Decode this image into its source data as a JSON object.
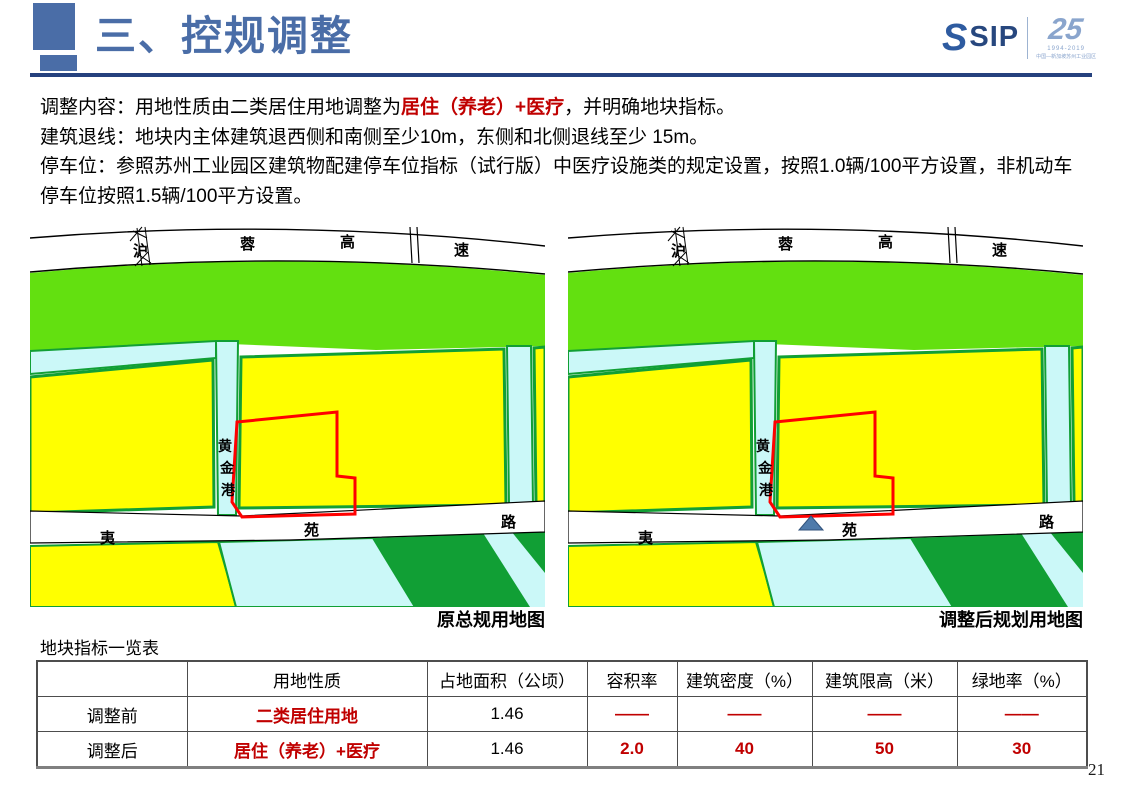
{
  "header": {
    "title": "三、控规调整",
    "logo": {
      "icon": "s-swoosh-icon",
      "sip": "SIP",
      "anniversary": "25",
      "years": "1994-2019",
      "org": "中国—新加坡苏州工业园区"
    }
  },
  "body": {
    "line1_prefix": "调整内容：用地性质由二类居住用地调整为",
    "line1_highlight": "居住（养老）+医疗",
    "line1_suffix": "，并明确地块指标。",
    "line2": "建筑退线：地块内主体建筑退西侧和南侧至少10m，东侧和北侧退线至少 15m。",
    "line3": "停车位：参照苏州工业园区建筑物配建停车位指标（试行版）中医疗设施类的规定设置，按照1.0辆/100平方设置，非机动车停车位按照1.5辆/100平方设置。"
  },
  "maps": {
    "highway_label": "沪蓉高速",
    "canal_label": "黄金港",
    "road_label": "夷苑路",
    "left_caption": "原总规用地图",
    "right_caption": "调整后规划用地图",
    "marker": "site-triangle-marker",
    "colors": {
      "green_open_space": "#63e010",
      "dark_green": "#119f35",
      "water_cyan": "#cbf8f8",
      "parcel_yellow": "#ffff00",
      "plot_outline_red": "#ff0000",
      "marker_blue": "#4f7bab"
    }
  },
  "table": {
    "title": "地块指标一览表",
    "headers": [
      "",
      "用地性质",
      "占地面积（公顷）",
      "容积率",
      "建筑密度（%）",
      "建筑限高（米）",
      "绿地率（%）"
    ],
    "rows": [
      {
        "label": "调整前",
        "land_use": "二类居住用地",
        "area": "1.46",
        "far": "——",
        "density": "——",
        "height_limit": "——",
        "green_rate": "——"
      },
      {
        "label": "调整后",
        "land_use": "居住（养老）+医疗",
        "area": "1.46",
        "far": "2.0",
        "density": "40",
        "height_limit": "50",
        "green_rate": "30"
      }
    ]
  },
  "page_number": "21",
  "accent_colors": {
    "title_blue": "#4a6da7",
    "underline_navy": "#25417e",
    "highlight_red": "#c00000"
  }
}
